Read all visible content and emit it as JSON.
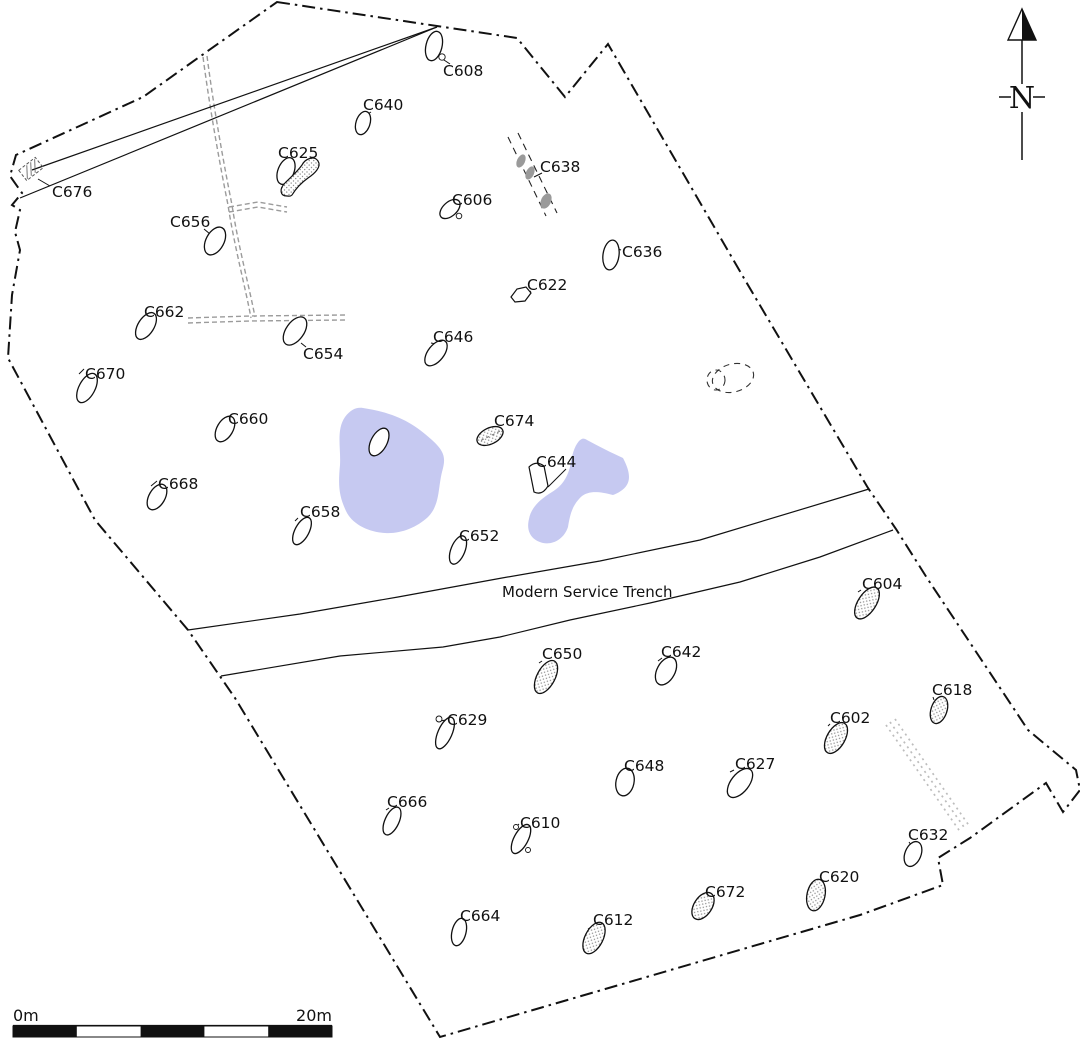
{
  "map": {
    "width": 1080,
    "height": 1039,
    "colors": {
      "ink": "#111111",
      "pond": "#c6c9f1",
      "drain": "#9b9b9b",
      "dotted_band": "#bdbdbd",
      "gray_blob": "#9a9a9a",
      "stipple_dot": "#8f8f8f",
      "background": "#ffffff"
    },
    "boundary_path": "M277,2 L517,38 L565,97 L608,44 L745,280 L868,488 L896,529 L927,578 L1028,730 L1076,770 L1080,790 L1063,812 L1046,783 L970,838 L938,858 L943,885 L860,915 L440,1037 L235,698 L188,630 L95,520 L8,358 L12,295 L20,250 L15,232 L20,210 L12,205 L22,193 L10,176 L16,155 L143,97 L205,53 Z",
    "enclosure_lines": [
      "M32,170 L437,27",
      "M20,198 L437,27"
    ],
    "hatch_box": {
      "cx": 31,
      "cy": 169,
      "w": 21,
      "h": 13,
      "rot": -38
    },
    "ponds": [
      "M363,408 C395,413 412,422 432,440 C445,452 446,458 442,472 C438,488 440,505 428,517 C416,528 400,534 385,533 C368,532 352,524 346,511 C339,496 338,486 340,465 C341,448 336,430 345,417 C351,409 357,407 363,408 Z",
      "M587,440 C598,446 612,453 623,458 C633,477 631,488 613,495 C598,491 589,491 582,496 C572,505 570,515 568,527 C564,539 553,545 543,543 C531,540 526,531 529,519 C531,508 539,500 552,492 C562,486 567,478 570,467 C572,455 574,447 579,441 C582,438 584,438 587,440 Z"
    ],
    "trench": {
      "label": "Modern Service Trench",
      "label_x": 502,
      "label_y": 597,
      "upper": "M188,630 L300,614 L398,597 L502,578 L600,561 L700,540 L869,489",
      "lower": "M221,676 L340,656 L443,647 L500,637 L570,620 L650,603 L740,582 L820,557 L893,530"
    },
    "drains": [
      "M203,57 C210,110 220,165 228,205 C234,245 246,290 251,318",
      "M207,56 C214,110 224,165 232,205 C238,245 250,290 255,317",
      "M229,207 L258,202 L287,207",
      "M229,212 L258,207 L287,212",
      "M188,318 L250,316 L345,315",
      "M188,323 L250,321 L345,320"
    ],
    "c638_lines": [
      "M508,137 L546,216",
      "M518,133 L557,213"
    ],
    "c638_blobs": [
      [
        521,
        161,
        4,
        7,
        25
      ],
      [
        530,
        173,
        4,
        7,
        25
      ],
      [
        546,
        201,
        5,
        8,
        25
      ]
    ],
    "dotted_band": [
      "M886,725 L961,833",
      "M895,719 L970,827",
      "M890,722 L966,830"
    ],
    "dashed_blobs": [
      [
        733,
        378,
        21,
        14,
        -15
      ],
      [
        716,
        380,
        9,
        10,
        0
      ]
    ],
    "north": {
      "label": "N",
      "x": 1022,
      "apex_y": 9,
      "base_y": 40,
      "half_w": 14,
      "line_top": [
        40,
        84
      ],
      "line_bottom": [
        112,
        160
      ],
      "label_y": 108,
      "dash_y": 97
    },
    "scale_bar": {
      "x": 13,
      "y": 1026,
      "w": 319,
      "h": 11,
      "segments": 5,
      "label_left": "0m",
      "label_right": "20m",
      "label_y": 1021
    }
  },
  "features": [
    {
      "label": "C608",
      "lx": 443,
      "ly": 76,
      "leader": [
        450,
        64,
        441,
        58
      ],
      "ellipse": [
        434,
        46,
        8,
        15,
        14
      ],
      "style": "plain",
      "dots": [
        [
          442,
          57,
          3.2
        ]
      ]
    },
    {
      "label": "C640",
      "lx": 363,
      "ly": 110,
      "leader": [
        371,
        112,
        366,
        115
      ],
      "ellipse": [
        363,
        123,
        7,
        12,
        18
      ],
      "style": "plain"
    },
    {
      "label": "C625",
      "lx": 278,
      "ly": 158,
      "leader": [
        289,
        160,
        286,
        165
      ],
      "ellipse": [
        286,
        171,
        8,
        14,
        22
      ],
      "style": "plain",
      "path": "M287,196 C280,196 279,189 285,183 C291,177 297,172 302,165 C305,159 314,155 318,161 C322,167 314,174 308,178 C301,183 295,190 292,195 C290,197 289,196 287,196 Z",
      "path_style": "stippled"
    },
    {
      "label": "C638",
      "lx": 540,
      "ly": 172,
      "leader": [
        542,
        173,
        534,
        177
      ]
    },
    {
      "label": "C676",
      "lx": 52,
      "ly": 197,
      "leader": [
        50,
        186,
        38,
        179
      ]
    },
    {
      "label": "C606",
      "lx": 452,
      "ly": 205,
      "leader": [
        456,
        207,
        449,
        203
      ],
      "ellipse": [
        450,
        209,
        7,
        12,
        48
      ],
      "style": "plain",
      "dots": [
        [
          459,
          216,
          2.8
        ]
      ]
    },
    {
      "label": "C656",
      "lx": 170,
      "ly": 227,
      "leader": [
        204,
        229,
        210,
        234
      ],
      "ellipse": [
        215,
        241,
        9,
        15,
        28
      ],
      "style": "plain"
    },
    {
      "label": "C636",
      "lx": 622,
      "ly": 257,
      "leader": [
        621,
        250,
        615,
        248
      ],
      "ellipse": [
        611,
        255,
        8,
        15,
        8
      ],
      "style": "plain"
    },
    {
      "label": "C622",
      "lx": 527,
      "ly": 290,
      "leader": [
        531,
        291,
        526,
        294
      ],
      "path": "M511,297 L517,289 L526,287 L531,293 L525,301 L515,302 Z",
      "path_style": "plain"
    },
    {
      "label": "C662",
      "lx": 144,
      "ly": 317,
      "leader": [
        151,
        318,
        150,
        314
      ],
      "ellipse": [
        146,
        326,
        8,
        15,
        32
      ],
      "style": "plain"
    },
    {
      "label": "C654",
      "lx": 303,
      "ly": 359,
      "leader": [
        306,
        347,
        301,
        343
      ],
      "ellipse": [
        295,
        331,
        9,
        16,
        35
      ],
      "style": "plain"
    },
    {
      "label": "C646",
      "lx": 433,
      "ly": 342,
      "leader": [
        436,
        344,
        431,
        343
      ],
      "ellipse": [
        436,
        353,
        8,
        15,
        38
      ],
      "style": "plain"
    },
    {
      "label": "C670",
      "lx": 85,
      "ly": 379,
      "leader": [
        84,
        369,
        79,
        374
      ],
      "ellipse": [
        87,
        388,
        8,
        16,
        28
      ],
      "style": "plain"
    },
    {
      "label": "C660",
      "lx": 228,
      "ly": 424,
      "leader": [
        227,
        419,
        221,
        421
      ],
      "ellipse": [
        225,
        429,
        8,
        14,
        30
      ],
      "style": "plain"
    },
    {
      "label": "C674",
      "lx": 494,
      "ly": 426,
      "leader": [
        496,
        428,
        492,
        431
      ],
      "ellipse": [
        490,
        436,
        8,
        14,
        64
      ],
      "style": "stippled",
      "axis_dash": true
    },
    {
      "label": "C644",
      "lx": 536,
      "ly": 467,
      "leader": [
        566,
        469,
        548,
        487
      ],
      "path": "M529,467 Q536,460 544,466 L548,486 Q542,496 534,492 Z",
      "path_style": "plain"
    },
    {
      "label": "C668",
      "lx": 158,
      "ly": 489,
      "leader": [
        157,
        481,
        151,
        486
      ],
      "ellipse": [
        157,
        497,
        8,
        14,
        30
      ],
      "style": "plain"
    },
    {
      "label": "C658",
      "lx": 300,
      "ly": 517,
      "leader": [
        298,
        518,
        295,
        521
      ],
      "ellipse": [
        302,
        531,
        7,
        15,
        28
      ],
      "style": "plain"
    },
    {
      "label": "C652",
      "lx": 459,
      "ly": 541,
      "leader": [
        461,
        543,
        456,
        546
      ],
      "ellipse": [
        458,
        550,
        7,
        15,
        22
      ],
      "style": "plain"
    },
    {
      "label": "",
      "lx": 0,
      "ly": 0,
      "ellipse": [
        379,
        442,
        8,
        15,
        28
      ],
      "style": "plain"
    },
    {
      "label": "C604",
      "lx": 862,
      "ly": 589,
      "leader": [
        861,
        590,
        858,
        592
      ],
      "ellipse": [
        867,
        603,
        9,
        18,
        33
      ],
      "style": "stippled"
    },
    {
      "label": "C650",
      "lx": 542,
      "ly": 659,
      "leader": [
        542,
        661,
        539,
        663
      ],
      "ellipse": [
        546,
        677,
        9,
        18,
        28
      ],
      "style": "stippled"
    },
    {
      "label": "C642",
      "lx": 661,
      "ly": 657,
      "leader": [
        662,
        658,
        658,
        661
      ],
      "ellipse": [
        666,
        671,
        9,
        15,
        28
      ],
      "style": "plain"
    },
    {
      "label": "C618",
      "lx": 932,
      "ly": 695,
      "leader": [
        933,
        697,
        934,
        700
      ],
      "ellipse": [
        939,
        710,
        8,
        14,
        18
      ],
      "style": "stippled"
    },
    {
      "label": "C629",
      "lx": 447,
      "ly": 725,
      "leader": [
        446,
        720,
        440,
        721
      ],
      "ellipse": [
        445,
        733,
        7,
        17,
        24
      ],
      "style": "plain",
      "dots": [
        [
          439,
          719,
          3
        ]
      ]
    },
    {
      "label": "C602",
      "lx": 830,
      "ly": 723,
      "leader": [
        830,
        724,
        828,
        726
      ],
      "ellipse": [
        836,
        738,
        9,
        17,
        30
      ],
      "style": "stippled"
    },
    {
      "label": "C648",
      "lx": 624,
      "ly": 771,
      "leader": [
        625,
        772,
        621,
        774
      ],
      "ellipse": [
        625,
        782,
        9,
        14,
        12
      ],
      "style": "plain"
    },
    {
      "label": "C627",
      "lx": 735,
      "ly": 769,
      "leader": [
        734,
        770,
        730,
        772
      ],
      "ellipse": [
        740,
        783,
        9,
        17,
        38
      ],
      "style": "plain"
    },
    {
      "label": "C666",
      "lx": 387,
      "ly": 807,
      "leader": [
        389,
        808,
        386,
        810
      ],
      "ellipse": [
        392,
        821,
        7,
        15,
        25
      ],
      "style": "plain"
    },
    {
      "label": "C610",
      "lx": 520,
      "ly": 828,
      "leader": [
        519,
        824,
        515,
        828
      ],
      "ellipse": [
        521,
        839,
        7,
        16,
        28
      ],
      "style": "plain",
      "dots": [
        [
          516,
          827,
          2.5
        ],
        [
          528,
          850,
          2.5
        ]
      ]
    },
    {
      "label": "C632",
      "lx": 908,
      "ly": 840,
      "leader": [
        909,
        842,
        911,
        845
      ],
      "ellipse": [
        913,
        854,
        8,
        13,
        22
      ],
      "style": "plain"
    },
    {
      "label": "C620",
      "lx": 819,
      "ly": 882,
      "leader": [
        819,
        883,
        815,
        884
      ],
      "ellipse": [
        816,
        895,
        9,
        16,
        12
      ],
      "style": "stippled"
    },
    {
      "label": "C672",
      "lx": 705,
      "ly": 897,
      "leader": [
        706,
        898,
        701,
        900
      ],
      "ellipse": [
        703,
        906,
        9,
        15,
        33
      ],
      "style": "stippled"
    },
    {
      "label": "C664",
      "lx": 460,
      "ly": 921,
      "leader": [
        461,
        922,
        457,
        924
      ],
      "ellipse": [
        459,
        932,
        7,
        14,
        14
      ],
      "style": "plain"
    },
    {
      "label": "C612",
      "lx": 593,
      "ly": 925,
      "leader": [
        593,
        926,
        588,
        929
      ],
      "ellipse": [
        594,
        938,
        9,
        17,
        27
      ],
      "style": "stippled"
    }
  ]
}
